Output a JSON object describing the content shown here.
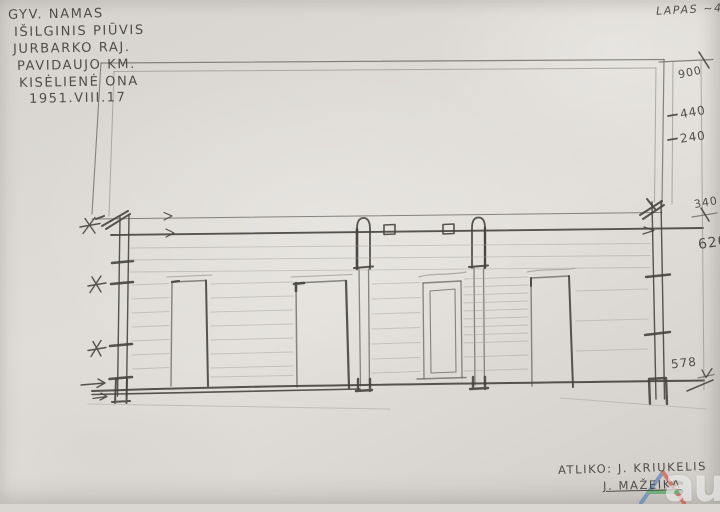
{
  "document": {
    "type": "hand-drawn architectural longitudinal section sketch (pencil on paper)",
    "paper_color": "#dbd8d2",
    "pencil_color": "#55534e"
  },
  "sheet_label": "LAPAS ~4",
  "title_block": {
    "lines": [
      "GYV. NAMAS",
      "IŠILGINIS PIŪVIS",
      "JURBARKO RAJ.",
      "PAVIDAUJO KM.",
      "KISĖLIENĖ ONA",
      "1951.VIII.17"
    ]
  },
  "dimensions": [
    "900",
    "440",
    "240",
    "340",
    "620",
    "578"
  ],
  "attribution": {
    "line1": "ATLIKO: J. KRIUKELIS",
    "line2": "J. MAŽEIKA"
  },
  "watermark": {
    "text": "autc",
    "triangle_colors": [
      "#4a79b8",
      "#d2452f",
      "#3f9e4d"
    ]
  }
}
